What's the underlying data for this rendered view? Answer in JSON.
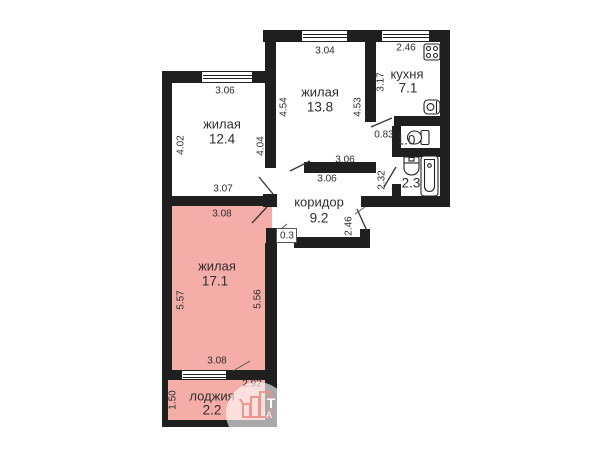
{
  "plan_type": "apartment-floor-plan",
  "rooms": [
    {
      "id": "living-12-4",
      "name": "жилая",
      "area": "12.4",
      "dims": {
        "top": "3.06",
        "left": "4.02",
        "right": "4.04",
        "bottom": "3.07"
      }
    },
    {
      "id": "living-13-8",
      "name": "жилая",
      "area": "13.8",
      "dims": {
        "top": "3.04",
        "left": "4.54",
        "right": "4.53",
        "bottom_above": "3.06",
        "bottom_below": "3.06"
      }
    },
    {
      "id": "kitchen",
      "name": "кухня",
      "area": "7.1",
      "dims": {
        "top": "2.46",
        "left": "3.17",
        "door": "0.83"
      }
    },
    {
      "id": "wc",
      "name": "",
      "area": "1.0",
      "dims": {}
    },
    {
      "id": "bathroom",
      "name": "",
      "area": "2.3",
      "dims": {
        "left": "2.32"
      }
    },
    {
      "id": "corridor",
      "name": "коридор",
      "area": "9.2",
      "dims": {
        "right": "2.46",
        "niche": "0.3"
      }
    },
    {
      "id": "living-17-1",
      "name": "жилая",
      "area": "17.1",
      "dims": {
        "top": "3.08",
        "left": "5.57",
        "right": "5.56",
        "bottom": "3.08"
      }
    },
    {
      "id": "loggia",
      "name": "лоджия",
      "area": "2.2",
      "dims": {
        "left": "1.50",
        "width": "2.92"
      }
    }
  ],
  "fixtures": [
    "stove-icon",
    "kitchen-sink-icon",
    "toilet-icon",
    "washbasin-icon",
    "bathtub-icon"
  ],
  "watermark": {
    "letter_top": "Т",
    "letter_bottom": "А"
  },
  "colors": {
    "wall": "#1f1f1f",
    "highlight_room_fill": "#f5ada7"
  }
}
